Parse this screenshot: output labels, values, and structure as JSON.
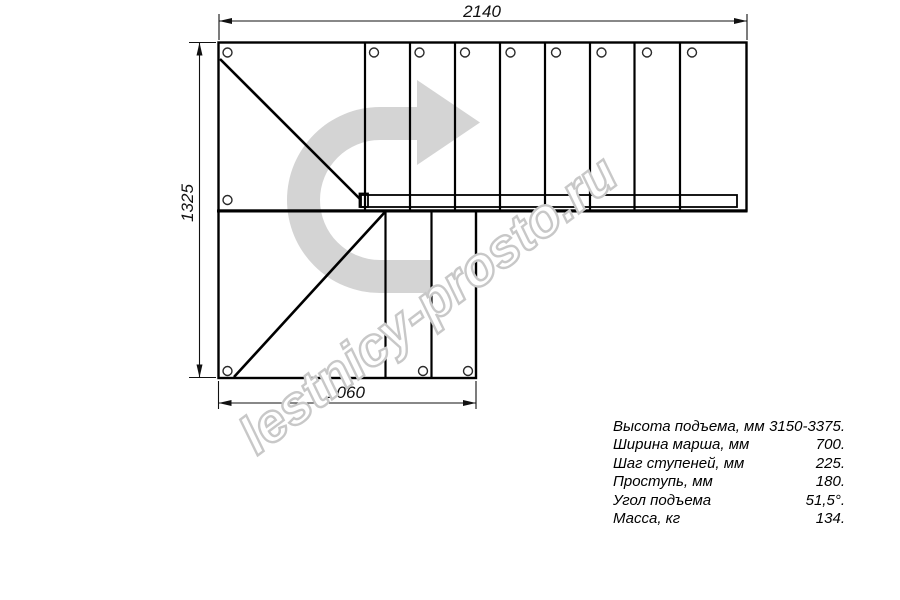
{
  "dimensions": {
    "top": "2140",
    "left": "1325",
    "bottom": "1060"
  },
  "specs": {
    "rows": [
      {
        "label": "Высота подъема, мм",
        "value": "3150-3375."
      },
      {
        "label": "Ширина марша, мм",
        "value": "700."
      },
      {
        "label": "Шаг ступеней, мм",
        "value": "225."
      },
      {
        "label": "Проступь, мм",
        "value": "180."
      },
      {
        "label": "Угол подъема",
        "value": "51,5°."
      },
      {
        "label": "Масса, кг",
        "value": "134."
      }
    ]
  },
  "watermark": {
    "text": "lestnicy-prosto.ru",
    "outline_color": "#c8c8c8"
  },
  "icons": {
    "direction_arrow": "curved-arrow-up-right"
  },
  "colors": {
    "line": "#000000",
    "dimension_line": "#111111",
    "arrow_fill": "#d4d4d4",
    "background": "#ffffff"
  }
}
